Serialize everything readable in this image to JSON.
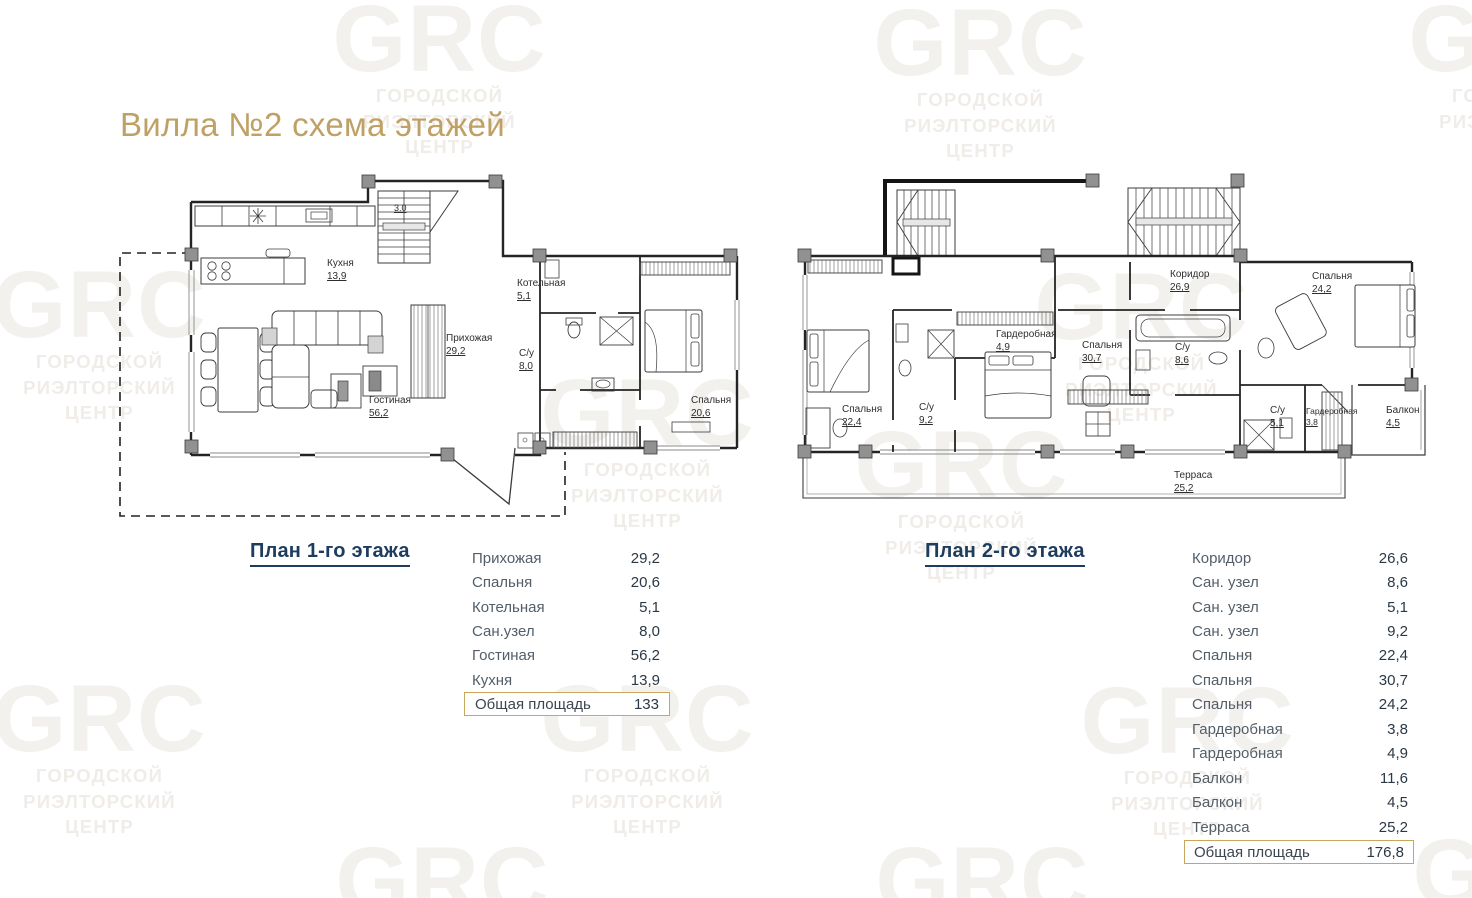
{
  "title": "Вилла №2 схема этажей",
  "watermark": {
    "logo": "GRC",
    "line1": "ГОРОДСКОЙ",
    "line2": "РИЭЛТОРСКИЙ",
    "line3": "ЦЕНТР"
  },
  "colors": {
    "accent_gold": "#C9A55E",
    "heading_navy": "#1E3C5E",
    "text_dark": "#2B3845",
    "text_gray": "#535E68",
    "plan_line": "#3C3C3C",
    "watermark_gray": "#F1EEEA"
  },
  "plan1": {
    "heading": "План 1-го этажа",
    "stairs_note": "3.0",
    "rooms": [
      {
        "name": "Кухня",
        "area": "13,9"
      },
      {
        "name": "Прихожая",
        "area": "29,2"
      },
      {
        "name": "Гостиная",
        "area": "56,2"
      },
      {
        "name": "Котельная",
        "area": "5,1"
      },
      {
        "name": "С/у",
        "area": "8,0"
      },
      {
        "name": "Спальня",
        "area": "20,6"
      }
    ],
    "table": {
      "rows": [
        {
          "label": "Прихожая",
          "value": "29,2"
        },
        {
          "label": "Спальня",
          "value": "20,6"
        },
        {
          "label": "Котельная",
          "value": "5,1"
        },
        {
          "label": "Сан.узел",
          "value": "8,0"
        },
        {
          "label": "Гостиная",
          "value": "56,2"
        },
        {
          "label": "Кухня",
          "value": "13,9"
        }
      ],
      "total_label": "Общая площадь",
      "total_value": "133"
    }
  },
  "plan2": {
    "heading": "План 2-го этажа",
    "rooms": [
      {
        "name": "Коридор",
        "area": "26,9"
      },
      {
        "name": "Спальня",
        "area": "24,2"
      },
      {
        "name": "Гардеробная",
        "area": "4,9"
      },
      {
        "name": "Спальня",
        "area": "30,7"
      },
      {
        "name": "С/у",
        "area": "8,6"
      },
      {
        "name": "Спальня",
        "area": "22,4"
      },
      {
        "name": "С/у",
        "area": "9,2"
      },
      {
        "name": "С/у",
        "area": "5,1"
      },
      {
        "name": "Гардеробная",
        "area": "3,8"
      },
      {
        "name": "Балкон",
        "area": "4,5"
      },
      {
        "name": "Терраса",
        "area": "25,2"
      }
    ],
    "table": {
      "rows": [
        {
          "label": "Коридор",
          "value": "26,6"
        },
        {
          "label": "Сан. узел",
          "value": "8,6"
        },
        {
          "label": "Сан. узел",
          "value": "5,1"
        },
        {
          "label": "Сан. узел",
          "value": "9,2"
        },
        {
          "label": "Спальня",
          "value": "22,4"
        },
        {
          "label": "Спальня",
          "value": "30,7"
        },
        {
          "label": "Спальня",
          "value": "24,2"
        },
        {
          "label": "Гардеробная",
          "value": "3,8"
        },
        {
          "label": "Гардеробная",
          "value": "4,9"
        },
        {
          "label": "Балкон",
          "value": "11,6"
        },
        {
          "label": "Балкон",
          "value": "4,5"
        },
        {
          "label": "Терраса",
          "value": "25,2"
        }
      ],
      "total_label": "Общая площадь",
      "total_value": "176,8"
    }
  }
}
